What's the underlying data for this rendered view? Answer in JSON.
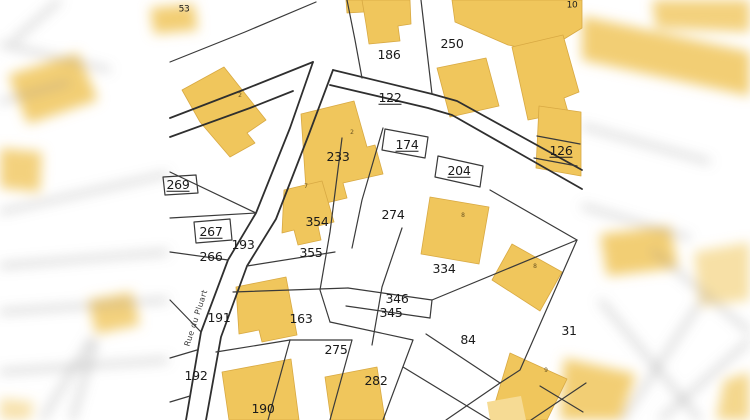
{
  "map": {
    "type": "cadastral-parcel-map",
    "street_name": "Rue du Pluart",
    "palette": {
      "background": "#FFFFFF",
      "building_fill": "#F0C65C",
      "building_fill_light": "#F6DB94",
      "building_stroke": "#D8A943",
      "parcel_line": "#3A3A3A",
      "blur_line": "#8A8A8A",
      "label": "#1A1A1A"
    },
    "parcel_labels": [
      {
        "text": "186",
        "x": 389,
        "y": 55,
        "underlined": false
      },
      {
        "text": "250",
        "x": 452,
        "y": 44,
        "underlined": false
      },
      {
        "text": "122",
        "x": 390,
        "y": 98,
        "underlined": true
      },
      {
        "text": "233",
        "x": 338,
        "y": 157,
        "underlined": false
      },
      {
        "text": "174",
        "x": 407,
        "y": 145,
        "underlined": true
      },
      {
        "text": "204",
        "x": 459,
        "y": 171,
        "underlined": true
      },
      {
        "text": "126",
        "x": 561,
        "y": 151,
        "underlined": true
      },
      {
        "text": "269",
        "x": 178,
        "y": 185,
        "underlined": true
      },
      {
        "text": "354",
        "x": 317,
        "y": 222,
        "underlined": false
      },
      {
        "text": "274",
        "x": 393,
        "y": 215,
        "underlined": false
      },
      {
        "text": "267",
        "x": 211,
        "y": 232,
        "underlined": true
      },
      {
        "text": "193",
        "x": 243,
        "y": 245,
        "underlined": false
      },
      {
        "text": "266",
        "x": 211,
        "y": 257,
        "underlined": false
      },
      {
        "text": "355",
        "x": 311,
        "y": 253,
        "underlined": false
      },
      {
        "text": "334",
        "x": 444,
        "y": 269,
        "underlined": false
      },
      {
        "text": "346",
        "x": 397,
        "y": 299,
        "underlined": false
      },
      {
        "text": "345",
        "x": 391,
        "y": 313,
        "underlined": false
      },
      {
        "text": "191",
        "x": 219,
        "y": 318,
        "underlined": false
      },
      {
        "text": "163",
        "x": 301,
        "y": 319,
        "underlined": false
      },
      {
        "text": "84",
        "x": 468,
        "y": 340,
        "underlined": false
      },
      {
        "text": "31",
        "x": 569,
        "y": 331,
        "underlined": false
      },
      {
        "text": "275",
        "x": 336,
        "y": 350,
        "underlined": false
      },
      {
        "text": "192",
        "x": 196,
        "y": 376,
        "underlined": false
      },
      {
        "text": "282",
        "x": 376,
        "y": 381,
        "underlined": false
      },
      {
        "text": "190",
        "x": 263,
        "y": 409,
        "underlined": false
      },
      {
        "text": "10",
        "x": 572,
        "y": 6,
        "underlined": false,
        "small": true
      },
      {
        "text": "53",
        "x": 184,
        "y": 10,
        "underlined": false,
        "small": true
      }
    ],
    "building_marks": [
      {
        "text": "2",
        "x": 240,
        "y": 96
      },
      {
        "text": "2",
        "x": 352,
        "y": 133
      },
      {
        "text": "7",
        "x": 306,
        "y": 187
      },
      {
        "text": "8",
        "x": 463,
        "y": 216
      },
      {
        "text": "8",
        "x": 535,
        "y": 267
      },
      {
        "text": "9",
        "x": 546,
        "y": 371
      }
    ]
  }
}
